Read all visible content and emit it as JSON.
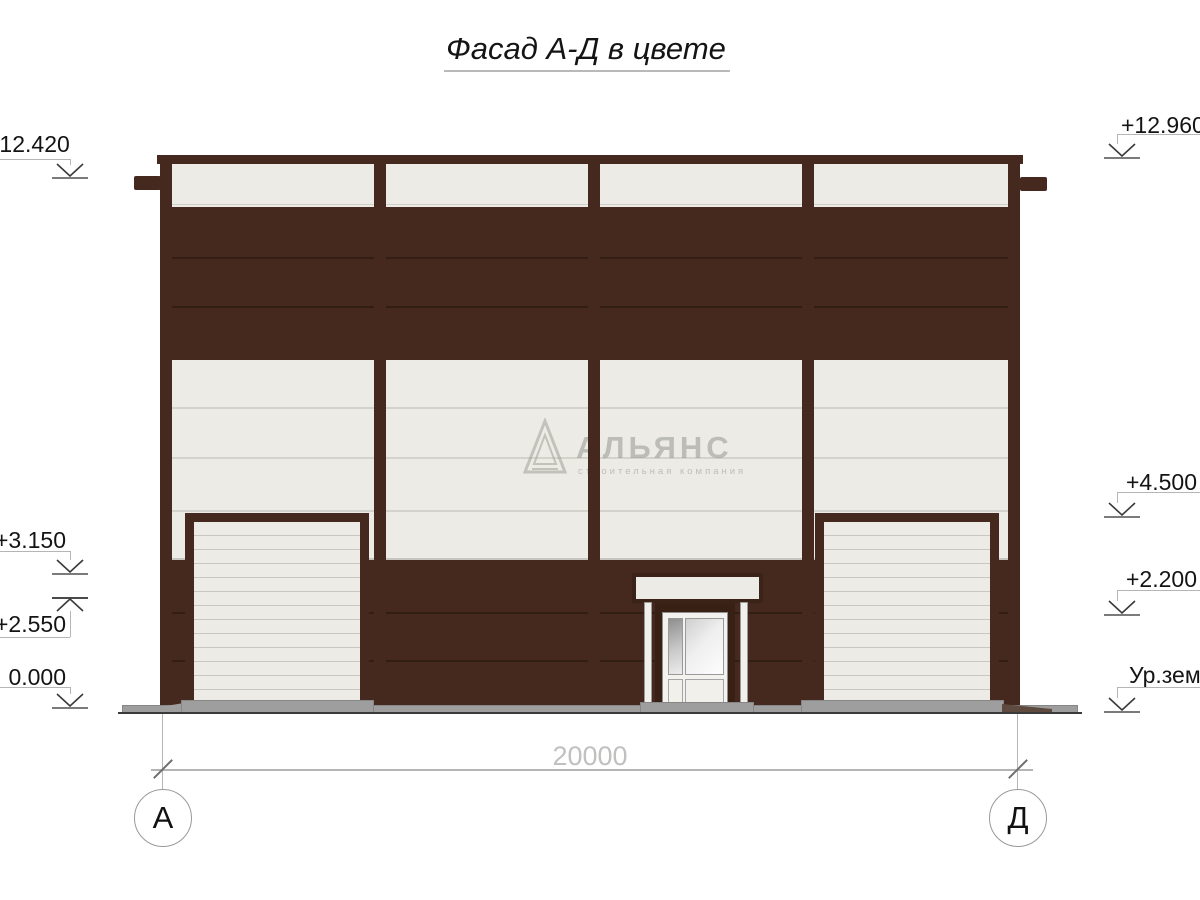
{
  "title": "Фасад А-Д в цвете",
  "levels": {
    "left": [
      {
        "label": "+12.420"
      },
      {
        "label": "+3.150"
      },
      {
        "label": "+2.550"
      },
      {
        "label": "0.000"
      }
    ],
    "right": [
      {
        "label": "+12.960"
      },
      {
        "label": "+4.500"
      },
      {
        "label": "+2.200"
      },
      {
        "label": "Ур.зем."
      }
    ]
  },
  "dimension": {
    "length": "20000"
  },
  "axes": {
    "left": "А",
    "right": "Д"
  },
  "watermark": {
    "brand": "АЛЬЯНС",
    "tagline": "строительная компания"
  },
  "colors": {
    "facade_dark": "#45291E",
    "facade_light": "#ECEBE5",
    "plinth_gray": "#9E9E9E",
    "line_gray": "#B5B5B5"
  }
}
